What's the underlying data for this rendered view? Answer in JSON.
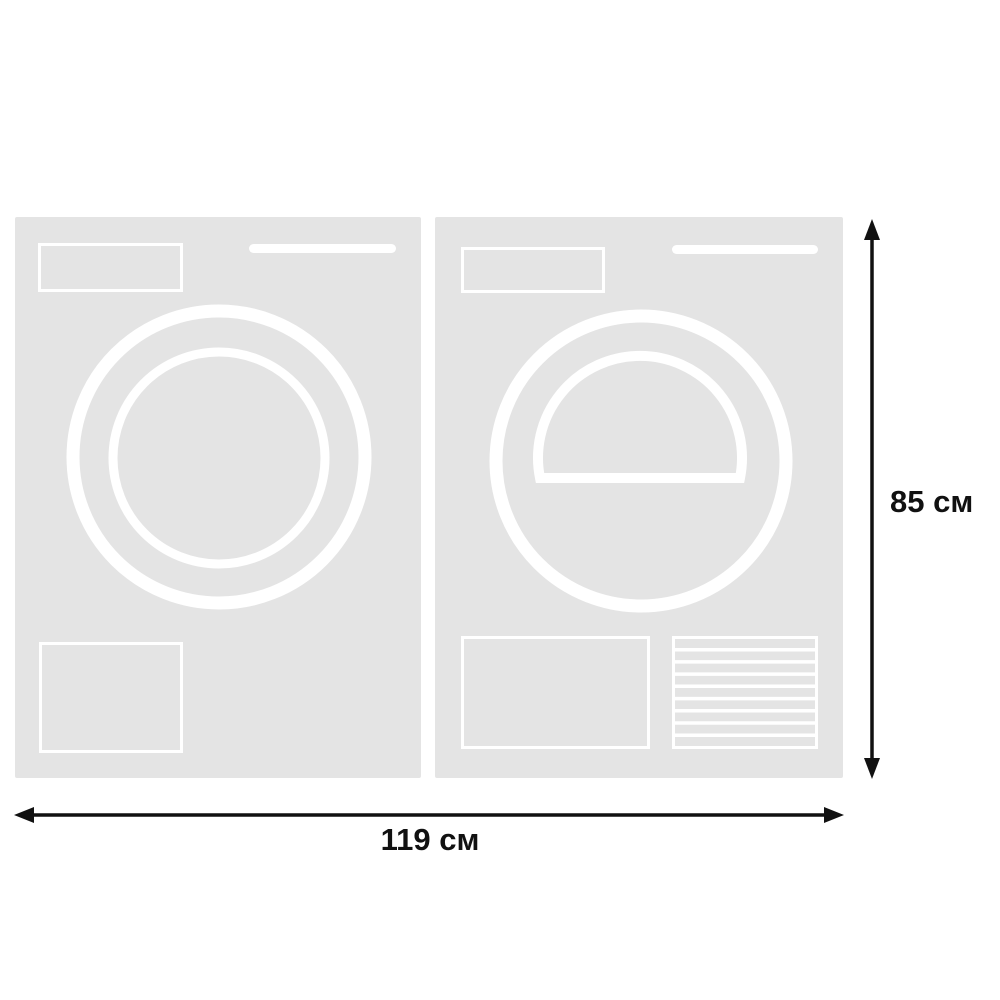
{
  "diagram": {
    "width_label": "119 см",
    "height_label": "85 см",
    "icons": [
      {
        "name": "washing-machine-front-icon",
        "meaning": "washing machine front view: control panel, detergent bar, round porthole door, service hatch"
      },
      {
        "name": "tumble-dryer-front-icon",
        "meaning": "tumble dryer front view: control panel, bar, round door with dome window, service hatch, louvered filter vent"
      }
    ],
    "vent_slats": 9,
    "colors": {
      "background": "#ffffff",
      "appliance_fill": "#e4e4e4",
      "appliance_outline": "#ffffff",
      "dimension": "#111111"
    }
  }
}
